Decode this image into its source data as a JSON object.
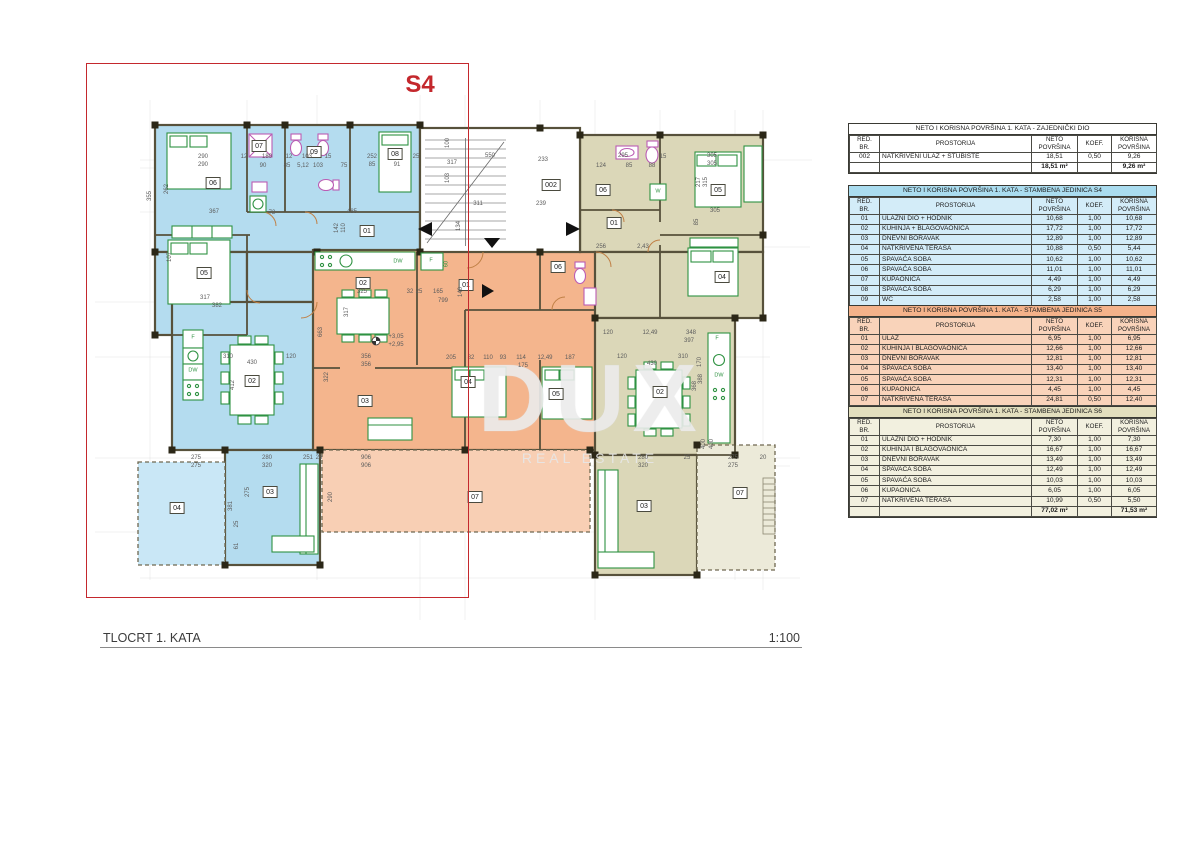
{
  "page": {
    "highlight_label": "S4",
    "drawing_title": "TLOCRT 1. KATA",
    "scale": "1:100",
    "watermark_line1": "DUX",
    "watermark_line2": "REAL ESTATE"
  },
  "colors": {
    "red": "#c4282d",
    "unit-s4": "#b4dcef",
    "unit-s4-terrace": "#c9e7f6",
    "unit-s5": "#f4b58d",
    "unit-s5-terrace": "#f8cfb4",
    "unit-s6": "#dbd7b8",
    "unit-s6-terrace": "#ecead9",
    "wall": "#57513b",
    "pier": "#2b2717",
    "furniture": "#2f9242",
    "sanitary": "#bb5cb4",
    "door": "#c08046"
  },
  "table_columns": [
    "RED.\nBR.",
    "PROSTORIJA",
    "NETO\nPOVRŠINA",
    "KOEF.",
    "KORISNA\nPOVRŠINA"
  ],
  "tables": [
    {
      "theme": "common",
      "top": 123,
      "title": "NETO I KORISNA POVRŠINA 1. KATA - ZAJEDNIČKI DIO",
      "rows": [
        [
          "002",
          "NATKRIVENI ULAZ + STUBIŠTE",
          "18,51",
          "0,50",
          "9,26"
        ]
      ],
      "total_neto": "18,51 m²",
      "total_korisna": "9,26 m²"
    },
    {
      "theme": "s4",
      "top": 185,
      "title": "NETO I KORISNA POVRŠINA 1. KATA - STAMBENA JEDINICA S4",
      "rows": [
        [
          "01",
          "ULAZNI DIO + HODNIK",
          "10,68",
          "1,00",
          "10,68"
        ],
        [
          "02",
          "KUHINJA + BLAGOVAONICA",
          "17,72",
          "1,00",
          "17,72"
        ],
        [
          "03",
          "DNEVNI BORAVAK",
          "12,89",
          "1,00",
          "12,89"
        ],
        [
          "04",
          "NATKRIVENA TERASA",
          "10,88",
          "0,50",
          "5,44"
        ],
        [
          "05",
          "SPAVAĆA SOBA",
          "10,62",
          "1,00",
          "10,62"
        ],
        [
          "06",
          "SPAVAĆA SOBA",
          "11,01",
          "1,00",
          "11,01"
        ],
        [
          "07",
          "KUPAONICA",
          "4,49",
          "1,00",
          "4,49"
        ],
        [
          "08",
          "SPAVAĆA SOBA",
          "6,29",
          "1,00",
          "6,29"
        ],
        [
          "09",
          "WC",
          "2,58",
          "1,00",
          "2,58"
        ]
      ],
      "total_neto": "87,16 m²",
      "total_korisna": "81,72 m²"
    },
    {
      "theme": "s5",
      "top": 305,
      "title": "NETO I KORISNA POVRŠINA 1. KATA - STAMBENA JEDINICA S5",
      "rows": [
        [
          "01",
          "ULAZ",
          "6,95",
          "1,00",
          "6,95"
        ],
        [
          "02",
          "KUHINJA I BLAGOVAONICA",
          "12,66",
          "1,00",
          "12,66"
        ],
        [
          "03",
          "DNEVNI BORAVAK",
          "12,81",
          "1,00",
          "12,81"
        ],
        [
          "04",
          "SPAVAĆA SOBA",
          "13,40",
          "1,00",
          "13,40"
        ],
        [
          "05",
          "SPAVAĆA SOBA",
          "12,31",
          "1,00",
          "12,31"
        ],
        [
          "06",
          "KUPAONICA",
          "4,45",
          "1,00",
          "4,45"
        ],
        [
          "07",
          "NATKRIVENA TERASA",
          "24,81",
          "0,50",
          "12,40"
        ]
      ],
      "total_neto": "87,39 m²",
      "total_korisna": "74,98 m²"
    },
    {
      "theme": "s6",
      "top": 406,
      "title": "NETO I KORISNA POVRŠINA 1. KATA - STAMBENA JEDINICA S6",
      "rows": [
        [
          "01",
          "ULAZNI DIO + HODNIK",
          "7,30",
          "1,00",
          "7,30"
        ],
        [
          "02",
          "KUHINJA I BLAGOVAONICA",
          "16,67",
          "1,00",
          "16,67"
        ],
        [
          "03",
          "DNEVNI BORAVAK",
          "13,49",
          "1,00",
          "13,49"
        ],
        [
          "04",
          "SPAVAĆA SOBA",
          "12,49",
          "1,00",
          "12,49"
        ],
        [
          "05",
          "SPAVAĆA SOBA",
          "10,03",
          "1,00",
          "10,03"
        ],
        [
          "06",
          "KUPAONICA",
          "6,05",
          "1,00",
          "6,05"
        ],
        [
          "07",
          "NATKRIVENA TERASA",
          "10,99",
          "0,50",
          "5,50"
        ]
      ],
      "total_neto": "77,02 m²",
      "total_korisna": "71,53 m²"
    }
  ],
  "plan": {
    "rooms": [
      {
        "u": "s4",
        "t": "06",
        "x": 213,
        "y": 183
      },
      {
        "u": "s4",
        "t": "07",
        "x": 259,
        "y": 146
      },
      {
        "u": "s4",
        "t": "09",
        "x": 314,
        "y": 152
      },
      {
        "u": "s4",
        "t": "08",
        "x": 395,
        "y": 154
      },
      {
        "u": "s4",
        "t": "05",
        "x": 204,
        "y": 273
      },
      {
        "u": "s4",
        "t": "01",
        "x": 367,
        "y": 231
      },
      {
        "u": "s4",
        "t": "02",
        "x": 252,
        "y": 381
      },
      {
        "u": "s4",
        "t": "03",
        "x": 270,
        "y": 492
      },
      {
        "u": "s4",
        "t": "04",
        "x": 177,
        "y": 508
      },
      {
        "u": "s5",
        "t": "02",
        "x": 363,
        "y": 283
      },
      {
        "u": "s5",
        "t": "01",
        "x": 466,
        "y": 285
      },
      {
        "u": "s5",
        "t": "06",
        "x": 558,
        "y": 267
      },
      {
        "u": "s5",
        "t": "03",
        "x": 365,
        "y": 401
      },
      {
        "u": "s5",
        "t": "04",
        "x": 468,
        "y": 382
      },
      {
        "u": "s5",
        "t": "05",
        "x": 556,
        "y": 394
      },
      {
        "u": "s5",
        "t": "07",
        "x": 475,
        "y": 497
      },
      {
        "u": "s6",
        "t": "06",
        "x": 603,
        "y": 190
      },
      {
        "u": "s6",
        "t": "01",
        "x": 614,
        "y": 223
      },
      {
        "u": "s6",
        "t": "05",
        "x": 718,
        "y": 190
      },
      {
        "u": "s6",
        "t": "04",
        "x": 722,
        "y": 277
      },
      {
        "u": "s6",
        "t": "02",
        "x": 660,
        "y": 392
      },
      {
        "u": "s6",
        "t": "03",
        "x": 644,
        "y": 506
      },
      {
        "u": "s6",
        "t": "07",
        "x": 740,
        "y": 493
      },
      {
        "u": "common",
        "t": "002",
        "x": 551,
        "y": 185
      }
    ],
    "dims": [
      {
        "t": "290",
        "x": 203,
        "y": 157
      },
      {
        "t": "290",
        "x": 203,
        "y": 165
      },
      {
        "t": "12",
        "x": 244,
        "y": 157
      },
      {
        "t": "180",
        "x": 267,
        "y": 157
      },
      {
        "t": "12",
        "x": 289,
        "y": 157
      },
      {
        "t": "103",
        "x": 307,
        "y": 157
      },
      {
        "t": "15",
        "x": 328,
        "y": 157
      },
      {
        "t": "90",
        "x": 263,
        "y": 166
      },
      {
        "t": "85",
        "x": 287,
        "y": 166
      },
      {
        "t": "5,12",
        "x": 303,
        "y": 166
      },
      {
        "t": "103",
        "x": 318,
        "y": 166
      },
      {
        "t": "75",
        "x": 344,
        "y": 166
      },
      {
        "t": "252",
        "x": 372,
        "y": 157
      },
      {
        "t": "85",
        "x": 372,
        "y": 165
      },
      {
        "t": "91",
        "x": 397,
        "y": 165
      },
      {
        "t": "25",
        "x": 416,
        "y": 157
      },
      {
        "t": "550",
        "x": 490,
        "y": 156
      },
      {
        "t": "317",
        "x": 452,
        "y": 163
      },
      {
        "t": "233",
        "x": 543,
        "y": 160
      },
      {
        "t": "311",
        "x": 478,
        "y": 204
      },
      {
        "t": "239",
        "x": 541,
        "y": 204
      },
      {
        "t": "134",
        "x": 459,
        "y": 226,
        "r": 1
      },
      {
        "t": "100",
        "x": 448,
        "y": 143,
        "r": 1
      },
      {
        "t": "103",
        "x": 448,
        "y": 178,
        "r": 1
      },
      {
        "t": "124",
        "x": 601,
        "y": 166
      },
      {
        "t": "295",
        "x": 623,
        "y": 156
      },
      {
        "t": "85",
        "x": 629,
        "y": 166
      },
      {
        "t": "88",
        "x": 652,
        "y": 166
      },
      {
        "t": "15",
        "x": 663,
        "y": 157
      },
      {
        "t": "305",
        "x": 712,
        "y": 156
      },
      {
        "t": "305",
        "x": 712,
        "y": 164
      },
      {
        "t": "217",
        "x": 699,
        "y": 182,
        "r": 1
      },
      {
        "t": "315",
        "x": 706,
        "y": 182,
        "r": 1
      },
      {
        "t": "305",
        "x": 715,
        "y": 211
      },
      {
        "t": "2,43",
        "x": 643,
        "y": 247
      },
      {
        "t": "256",
        "x": 601,
        "y": 247
      },
      {
        "t": "85",
        "x": 697,
        "y": 222,
        "r": 1
      },
      {
        "t": "355",
        "x": 150,
        "y": 196,
        "r": 1
      },
      {
        "t": "262",
        "x": 167,
        "y": 189,
        "r": 1
      },
      {
        "t": "367",
        "x": 214,
        "y": 212
      },
      {
        "t": "72",
        "x": 272,
        "y": 213
      },
      {
        "t": "485",
        "x": 352,
        "y": 212
      },
      {
        "t": "107",
        "x": 170,
        "y": 257,
        "r": 1
      },
      {
        "t": "142",
        "x": 337,
        "y": 228,
        "r": 1
      },
      {
        "t": "110",
        "x": 344,
        "y": 228,
        "r": 1
      },
      {
        "t": "317",
        "x": 205,
        "y": 298
      },
      {
        "t": "382",
        "x": 217,
        "y": 306
      },
      {
        "t": "310",
        "x": 228,
        "y": 357
      },
      {
        "t": "430",
        "x": 252,
        "y": 363
      },
      {
        "t": "120",
        "x": 291,
        "y": 357
      },
      {
        "t": "412",
        "x": 233,
        "y": 385,
        "r": 1
      },
      {
        "t": "322",
        "x": 327,
        "y": 377,
        "r": 1
      },
      {
        "t": "663",
        "x": 321,
        "y": 332,
        "r": 1
      },
      {
        "t": "325",
        "x": 362,
        "y": 292
      },
      {
        "t": "32",
        "x": 410,
        "y": 292
      },
      {
        "t": "25",
        "x": 419,
        "y": 292
      },
      {
        "t": "165",
        "x": 438,
        "y": 292
      },
      {
        "t": "799",
        "x": 443,
        "y": 301
      },
      {
        "t": "140",
        "x": 461,
        "y": 292,
        "r": 1
      },
      {
        "t": "317",
        "x": 347,
        "y": 312,
        "r": 1
      },
      {
        "t": "356",
        "x": 366,
        "y": 357
      },
      {
        "t": "356",
        "x": 366,
        "y": 365
      },
      {
        "t": "+3,05",
        "x": 396,
        "y": 337
      },
      {
        "t": "+2,95",
        "x": 396,
        "y": 345
      },
      {
        "t": "205",
        "x": 451,
        "y": 358
      },
      {
        "t": "82",
        "x": 471,
        "y": 358
      },
      {
        "t": "110",
        "x": 488,
        "y": 358
      },
      {
        "t": "93",
        "x": 503,
        "y": 358
      },
      {
        "t": "114",
        "x": 521,
        "y": 358
      },
      {
        "t": "175",
        "x": 523,
        "y": 366
      },
      {
        "t": "12,49",
        "x": 545,
        "y": 358
      },
      {
        "t": "187",
        "x": 570,
        "y": 358
      },
      {
        "t": "120",
        "x": 622,
        "y": 357
      },
      {
        "t": "430",
        "x": 652,
        "y": 364
      },
      {
        "t": "310",
        "x": 683,
        "y": 357
      },
      {
        "t": "348",
        "x": 691,
        "y": 333
      },
      {
        "t": "397",
        "x": 689,
        "y": 341
      },
      {
        "t": "12,49",
        "x": 650,
        "y": 333
      },
      {
        "t": "120",
        "x": 608,
        "y": 333
      },
      {
        "t": "170",
        "x": 700,
        "y": 362,
        "r": 1
      },
      {
        "t": "368",
        "x": 695,
        "y": 386,
        "r": 1
      },
      {
        "t": "388",
        "x": 701,
        "y": 379,
        "r": 1
      },
      {
        "t": "906",
        "x": 366,
        "y": 458
      },
      {
        "t": "906",
        "x": 366,
        "y": 466
      },
      {
        "t": "290",
        "x": 331,
        "y": 497,
        "r": 1
      },
      {
        "t": "275",
        "x": 196,
        "y": 458
      },
      {
        "t": "275",
        "x": 196,
        "y": 466
      },
      {
        "t": "280",
        "x": 267,
        "y": 458
      },
      {
        "t": "320",
        "x": 267,
        "y": 466
      },
      {
        "t": "251",
        "x": 308,
        "y": 458
      },
      {
        "t": "26",
        "x": 319,
        "y": 458
      },
      {
        "t": "275",
        "x": 248,
        "y": 492,
        "r": 1
      },
      {
        "t": "381",
        "x": 231,
        "y": 506,
        "r": 1
      },
      {
        "t": "61",
        "x": 237,
        "y": 546,
        "r": 1
      },
      {
        "t": "25",
        "x": 237,
        "y": 524,
        "r": 1
      },
      {
        "t": "280",
        "x": 643,
        "y": 458
      },
      {
        "t": "320",
        "x": 643,
        "y": 466
      },
      {
        "t": "25",
        "x": 687,
        "y": 458
      },
      {
        "t": "275",
        "x": 733,
        "y": 458
      },
      {
        "t": "275",
        "x": 733,
        "y": 466
      },
      {
        "t": "20",
        "x": 763,
        "y": 458
      },
      {
        "t": "400",
        "x": 704,
        "y": 444,
        "r": 1
      },
      {
        "t": "400",
        "x": 712,
        "y": 444,
        "r": 1
      },
      {
        "t": "DW",
        "x": 398,
        "y": 262,
        "c": 1
      },
      {
        "t": "F",
        "x": 431,
        "y": 261,
        "c": 1
      },
      {
        "t": "60",
        "x": 447,
        "y": 264,
        "c": 1,
        "r": 1
      },
      {
        "t": "F",
        "x": 193,
        "y": 338,
        "c": 1
      },
      {
        "t": "DW",
        "x": 193,
        "y": 371,
        "c": 1
      },
      {
        "t": "F",
        "x": 717,
        "y": 339,
        "c": 1
      },
      {
        "t": "DW",
        "x": 719,
        "y": 376,
        "c": 1
      },
      {
        "t": "W",
        "x": 658,
        "y": 192,
        "c": 1
      }
    ]
  }
}
